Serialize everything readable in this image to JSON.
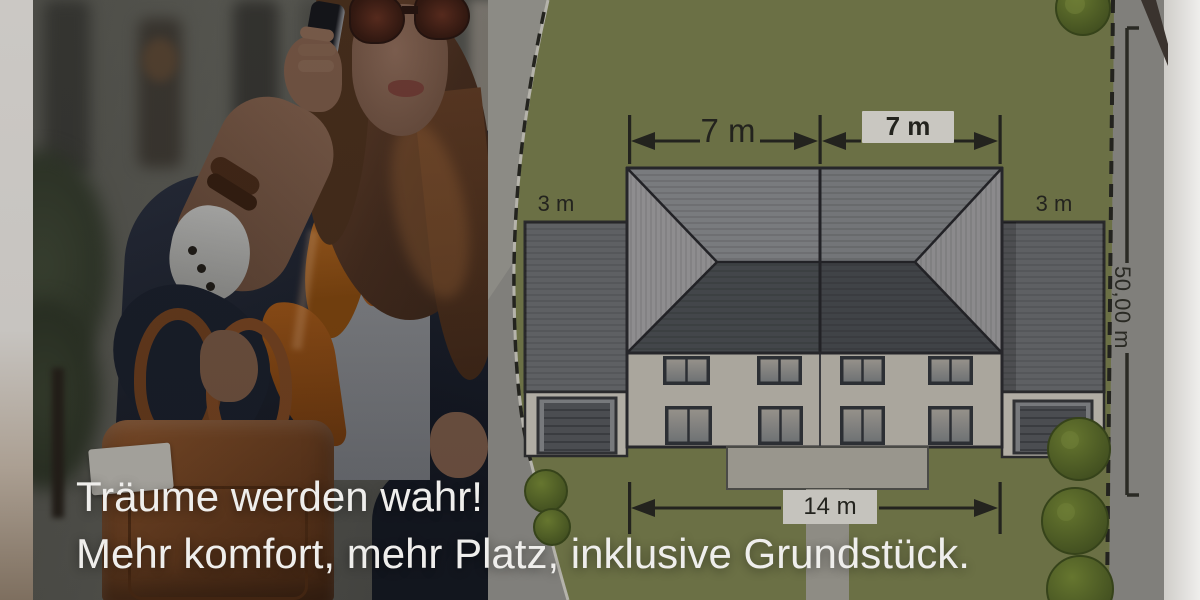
{
  "meta": {
    "type": "real-estate-ad-banner"
  },
  "headline": {
    "line1": "Träume werden wahr!",
    "line2": "Mehr komfort, mehr Platz, inklusive Grundstück."
  },
  "site_plan": {
    "labels": {
      "left_unit_width": "7 m",
      "right_unit_width": "7 m",
      "left_garage_width": "3 m",
      "right_garage_width": "3 m",
      "house_total_width": "14 m",
      "plot_depth": "50,00 m"
    },
    "elements": [
      "duplex-house",
      "garage-left",
      "garage-right",
      "terrace",
      "walk-path",
      "trees",
      "dashed-plot-boundary",
      "road"
    ]
  },
  "photo": {
    "subject": "businesswoman-on-phone-with-leather-bag"
  },
  "colors": {
    "lawn": "#6b7045",
    "road": "#807f7b",
    "roof_dark": "#43464a",
    "roof_mid": "#74767a",
    "facade": "#a7a39a",
    "dimension_ink": "#23231e",
    "headline_text": "#efeeec",
    "label_box": "#c9c7c1"
  }
}
